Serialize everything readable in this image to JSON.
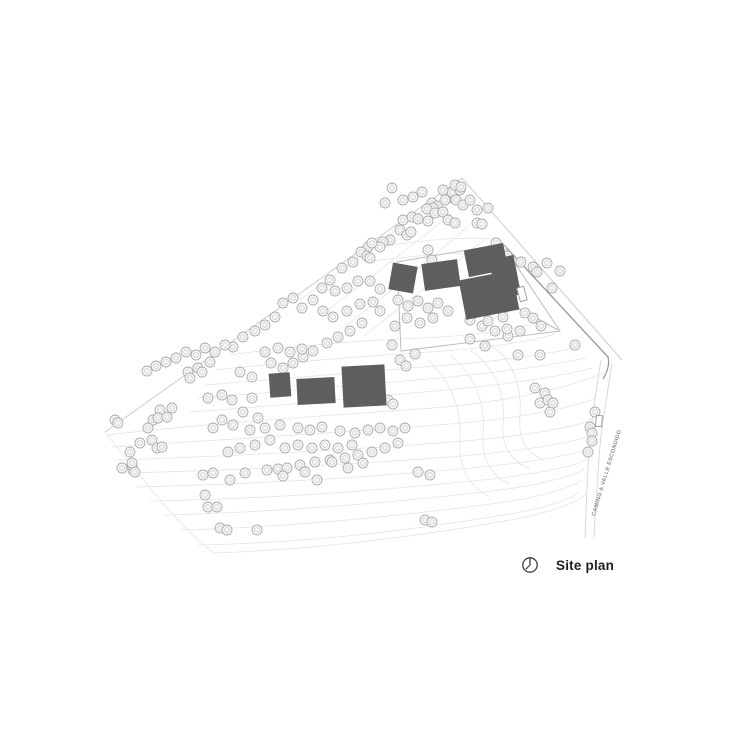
{
  "legend": {
    "title": "Site plan"
  },
  "road_label": "CAMINO A VALLE ESCONDIDO",
  "colors": {
    "background": "#ffffff",
    "contour": "#e4e4e4",
    "boundary": "#cdcdcd",
    "road": "#d9d9d9",
    "driveway": "#9b9b9b",
    "fence": "#bdbdbd",
    "tree_stroke": "#adadad",
    "tree_fill": "#f5f5f5",
    "tree_inner": "#cfcfcf",
    "building": "#5e5e5e",
    "structure_outline": "#9a9a9a",
    "title_text": "#1f1f1f",
    "road_label_text": "#8a8a8a",
    "north_arrow": "#3c3c3c"
  },
  "site": {
    "boundary": [
      "M 462,178 L 105,432",
      "M 462,178 L 622,360"
    ],
    "contours": [
      "M 430,205 C 390,235 342,270 300,300",
      "M 452,213 C 410,248 362,284 320,316",
      "M 468,227 C 428,261 385,296 344,327",
      "M 484,240 C 444,272 403,306 364,336",
      "M 385,246 C 420,241 460,236 495,239",
      "M 365,262 C 405,257 450,252 490,253",
      "M 230,355 C 300,345 370,340 422,338 C 470,336 512,330 540,322",
      "M 215,370 C 290,362 365,356 430,352 C 482,349 527,342 556,334",
      "M 205,385 C 285,378 362,372 435,366 C 492,362 541,355 576,348",
      "M 197,398 C 280,392 360,385 440,378 C 502,372 552,365 586,358",
      "M 190,412 C 275,406 360,398 445,390 C 512,384 562,376 592,368",
      "M 108,435 C 200,424 320,416 420,409 C 500,403 562,390 604,373",
      "M 112,447 C 215,440 335,433 438,425 C 518,419 572,408 596,398",
      "M 118,460 C 230,456 350,450 452,442 C 530,436 582,426 593,418",
      "M 126,473 C 242,470 362,464 462,456 C 540,449 586,440 591,434",
      "M 136,487 C 252,484 372,477 472,468 C 546,461 585,452 589,448",
      "M 150,501 C 266,499 386,490 482,480 C 550,473 583,463 587,459",
      "M 164,515 C 282,512 398,502 492,491 C 553,484 580,472 584,469",
      "M 180,530 C 297,527 408,515 498,503 C 556,495 577,484 581,480",
      "M 198,545 C 312,543 418,529 504,515 C 559,506 575,496 579,492",
      "M 105,432 C 142,478 180,528 214,553 C 330,549 432,534 510,520 C 560,511 580,500 586,494",
      "M 428,360 C 452,382 462,412 460,440 C 458,466 468,486 488,496",
      "M 450,355 C 476,376 486,406 483,434 C 481,458 491,476 510,484",
      "M 470,350 C 496,368 506,395 503,424 C 501,447 511,461 530,469",
      "M 492,346 C 514,362 522,388 520,415 C 518,440 526,453 544,460"
    ],
    "roads": [
      "M 601,360 C 596,392 591,422 589,452 C 587,482 586,512 585,538",
      "M 612,364 C 607,396 601,428 599,458 C 597,486 595,514 594,538"
    ],
    "driveway": "M 504,245 L 608,357 C 610,365 607,372 603,379",
    "fence": "397,262 502,244 560,331 401,351",
    "connector": "M 518,308 L 558,330",
    "buildings": [
      {
        "cx": 403,
        "cy": 278,
        "w": 25,
        "h": 27,
        "a": 10
      },
      {
        "cx": 441,
        "cy": 275,
        "w": 36,
        "h": 27,
        "a": -8
      },
      {
        "cx": 486,
        "cy": 260,
        "w": 40,
        "h": 27,
        "a": -11
      },
      {
        "cx": 505,
        "cy": 277,
        "w": 25,
        "h": 40,
        "a": -11
      },
      {
        "cx": 489,
        "cy": 295,
        "w": 54,
        "h": 40,
        "a": -11
      },
      {
        "cx": 280,
        "cy": 385,
        "w": 21,
        "h": 24,
        "a": -4
      },
      {
        "cx": 316,
        "cy": 391,
        "w": 38,
        "h": 26,
        "a": -3
      },
      {
        "cx": 364,
        "cy": 386,
        "w": 43,
        "h": 41,
        "a": -3
      }
    ],
    "outline_structures": [
      {
        "cx": 522,
        "cy": 294,
        "w": 7,
        "h": 14,
        "a": -15
      },
      {
        "cx": 599,
        "cy": 421,
        "w": 6,
        "h": 11,
        "a": 5
      }
    ],
    "trees": [
      [
        392,
        188
      ],
      [
        403,
        200
      ],
      [
        385,
        203
      ],
      [
        413,
        197
      ],
      [
        422,
        192
      ],
      [
        432,
        203
      ],
      [
        437,
        206
      ],
      [
        448,
        198
      ],
      [
        452,
        192
      ],
      [
        456,
        200
      ],
      [
        460,
        190
      ],
      [
        463,
        205
      ],
      [
        488,
        208
      ],
      [
        477,
        210
      ],
      [
        443,
        190
      ],
      [
        455,
        185
      ],
      [
        461,
        187
      ],
      [
        445,
        200
      ],
      [
        470,
        200
      ],
      [
        433,
        208
      ],
      [
        427,
        209
      ],
      [
        403,
        220
      ],
      [
        412,
        217
      ],
      [
        418,
        219
      ],
      [
        428,
        221
      ],
      [
        435,
        213
      ],
      [
        443,
        212
      ],
      [
        448,
        220
      ],
      [
        455,
        223
      ],
      [
        477,
        223
      ],
      [
        482,
        224
      ],
      [
        400,
        230
      ],
      [
        407,
        235
      ],
      [
        411,
        232
      ],
      [
        390,
        240
      ],
      [
        383,
        242
      ],
      [
        368,
        247
      ],
      [
        380,
        247
      ],
      [
        361,
        252
      ],
      [
        367,
        256
      ],
      [
        428,
        250
      ],
      [
        432,
        260
      ],
      [
        502,
        250
      ],
      [
        507,
        256
      ],
      [
        496,
        243
      ],
      [
        521,
        262
      ],
      [
        533,
        267
      ],
      [
        547,
        263
      ],
      [
        552,
        288
      ],
      [
        537,
        272
      ],
      [
        560,
        271
      ],
      [
        372,
        243
      ],
      [
        370,
        258
      ],
      [
        353,
        262
      ],
      [
        342,
        268
      ],
      [
        330,
        280
      ],
      [
        322,
        288
      ],
      [
        335,
        291
      ],
      [
        347,
        288
      ],
      [
        358,
        281
      ],
      [
        370,
        281
      ],
      [
        380,
        289
      ],
      [
        293,
        298
      ],
      [
        302,
        308
      ],
      [
        283,
        303
      ],
      [
        275,
        317
      ],
      [
        265,
        325
      ],
      [
        255,
        331
      ],
      [
        243,
        337
      ],
      [
        233,
        347
      ],
      [
        313,
        300
      ],
      [
        323,
        311
      ],
      [
        333,
        317
      ],
      [
        347,
        311
      ],
      [
        360,
        304
      ],
      [
        373,
        302
      ],
      [
        380,
        311
      ],
      [
        362,
        323
      ],
      [
        350,
        331
      ],
      [
        338,
        337
      ],
      [
        327,
        343
      ],
      [
        313,
        351
      ],
      [
        303,
        357
      ],
      [
        293,
        363
      ],
      [
        283,
        368
      ],
      [
        271,
        363
      ],
      [
        398,
        300
      ],
      [
        408,
        306
      ],
      [
        418,
        301
      ],
      [
        428,
        308
      ],
      [
        438,
        303
      ],
      [
        448,
        311
      ],
      [
        433,
        318
      ],
      [
        420,
        323
      ],
      [
        407,
        318
      ],
      [
        395,
        326
      ],
      [
        400,
        360
      ],
      [
        406,
        366
      ],
      [
        415,
        354
      ],
      [
        392,
        345
      ],
      [
        470,
        320
      ],
      [
        482,
        326
      ],
      [
        495,
        331
      ],
      [
        508,
        336
      ],
      [
        520,
        331
      ],
      [
        525,
        313
      ],
      [
        533,
        318
      ],
      [
        541,
        326
      ],
      [
        503,
        317
      ],
      [
        507,
        329
      ],
      [
        488,
        321
      ],
      [
        518,
        355
      ],
      [
        540,
        355
      ],
      [
        470,
        339
      ],
      [
        485,
        346
      ],
      [
        225,
        345
      ],
      [
        215,
        352
      ],
      [
        205,
        348
      ],
      [
        196,
        355
      ],
      [
        186,
        352
      ],
      [
        176,
        358
      ],
      [
        166,
        362
      ],
      [
        156,
        366
      ],
      [
        147,
        371
      ],
      [
        210,
        362
      ],
      [
        198,
        368
      ],
      [
        188,
        372
      ],
      [
        115,
        420
      ],
      [
        118,
        423
      ],
      [
        130,
        452
      ],
      [
        122,
        468
      ],
      [
        133,
        470
      ],
      [
        132,
        465
      ],
      [
        140,
        443
      ],
      [
        160,
        410
      ],
      [
        153,
        420
      ],
      [
        158,
        418
      ],
      [
        148,
        428
      ],
      [
        152,
        440
      ],
      [
        157,
        448
      ],
      [
        162,
        447
      ],
      [
        167,
        417
      ],
      [
        172,
        408
      ],
      [
        208,
        398
      ],
      [
        222,
        395
      ],
      [
        232,
        400
      ],
      [
        252,
        398
      ],
      [
        243,
        412
      ],
      [
        258,
        418
      ],
      [
        233,
        425
      ],
      [
        222,
        420
      ],
      [
        213,
        428
      ],
      [
        250,
        430
      ],
      [
        265,
        428
      ],
      [
        280,
        425
      ],
      [
        270,
        440
      ],
      [
        255,
        445
      ],
      [
        240,
        448
      ],
      [
        228,
        452
      ],
      [
        285,
        448
      ],
      [
        298,
        445
      ],
      [
        312,
        448
      ],
      [
        325,
        445
      ],
      [
        338,
        448
      ],
      [
        352,
        445
      ],
      [
        310,
        430
      ],
      [
        322,
        427
      ],
      [
        298,
        428
      ],
      [
        340,
        431
      ],
      [
        355,
        433
      ],
      [
        368,
        430
      ],
      [
        380,
        428
      ],
      [
        393,
        431
      ],
      [
        405,
        428
      ],
      [
        398,
        443
      ],
      [
        385,
        448
      ],
      [
        372,
        452
      ],
      [
        358,
        455
      ],
      [
        345,
        458
      ],
      [
        330,
        460
      ],
      [
        315,
        462
      ],
      [
        300,
        465
      ],
      [
        132,
        463
      ],
      [
        135,
        472
      ],
      [
        203,
        475
      ],
      [
        213,
        473
      ],
      [
        230,
        480
      ],
      [
        245,
        473
      ],
      [
        267,
        470
      ],
      [
        278,
        469
      ],
      [
        287,
        468
      ],
      [
        305,
        472
      ],
      [
        317,
        480
      ],
      [
        332,
        462
      ],
      [
        348,
        468
      ],
      [
        363,
        463
      ],
      [
        418,
        472
      ],
      [
        430,
        475
      ],
      [
        283,
        476
      ],
      [
        205,
        495
      ],
      [
        208,
        507
      ],
      [
        217,
        507
      ],
      [
        220,
        528
      ],
      [
        227,
        530
      ],
      [
        257,
        530
      ],
      [
        425,
        520
      ],
      [
        432,
        522
      ],
      [
        535,
        388
      ],
      [
        545,
        393
      ],
      [
        540,
        403
      ],
      [
        550,
        412
      ],
      [
        548,
        400
      ],
      [
        553,
        403
      ],
      [
        595,
        412
      ],
      [
        590,
        427
      ],
      [
        592,
        433
      ],
      [
        592,
        441
      ],
      [
        588,
        452
      ],
      [
        575,
        345
      ],
      [
        388,
        400
      ],
      [
        393,
        404
      ],
      [
        265,
        352
      ],
      [
        278,
        348
      ],
      [
        290,
        352
      ],
      [
        302,
        349
      ],
      [
        252,
        377
      ],
      [
        240,
        372
      ],
      [
        190,
        378
      ],
      [
        202,
        372
      ]
    ]
  }
}
